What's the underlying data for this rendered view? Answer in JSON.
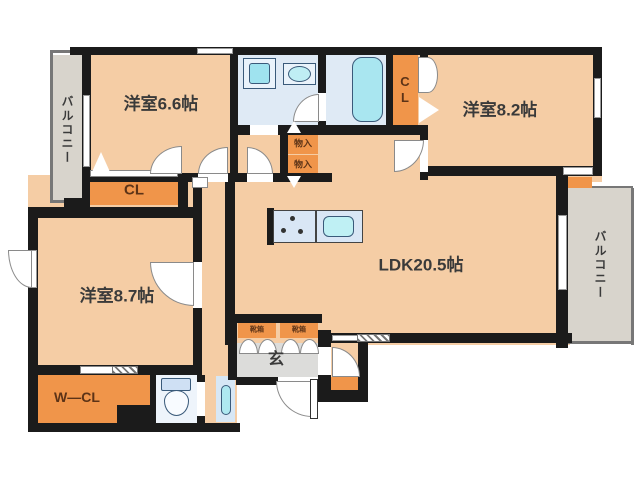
{
  "floorplan": {
    "rooms": {
      "bedroom_1": "洋室6.6帖",
      "bedroom_2": "洋室8.2帖",
      "bedroom_3": "洋室8.7帖",
      "ldk": "LDK20.5帖",
      "balcony_left": "バルコニー",
      "balcony_right": "バルコニー",
      "closet_1": "CL",
      "closet_2": "CL",
      "walkin_closet": "W―CL",
      "entrance": "玄",
      "storage_upper": "物入",
      "storage_lower": "物入",
      "shoebox_left": "靴箱",
      "shoebox_right": "靴箱"
    },
    "colors": {
      "wall": "#1b1b1b",
      "room_fill": "#f5cda5",
      "storage_fill": "#f0954a",
      "wet_area_fill": "#dfeaf5",
      "fixture_fill": "#abe7f0",
      "balcony_fill": "#d8d4cc",
      "entrance_fill": "#dcdcda",
      "background": "#ffffff"
    }
  }
}
